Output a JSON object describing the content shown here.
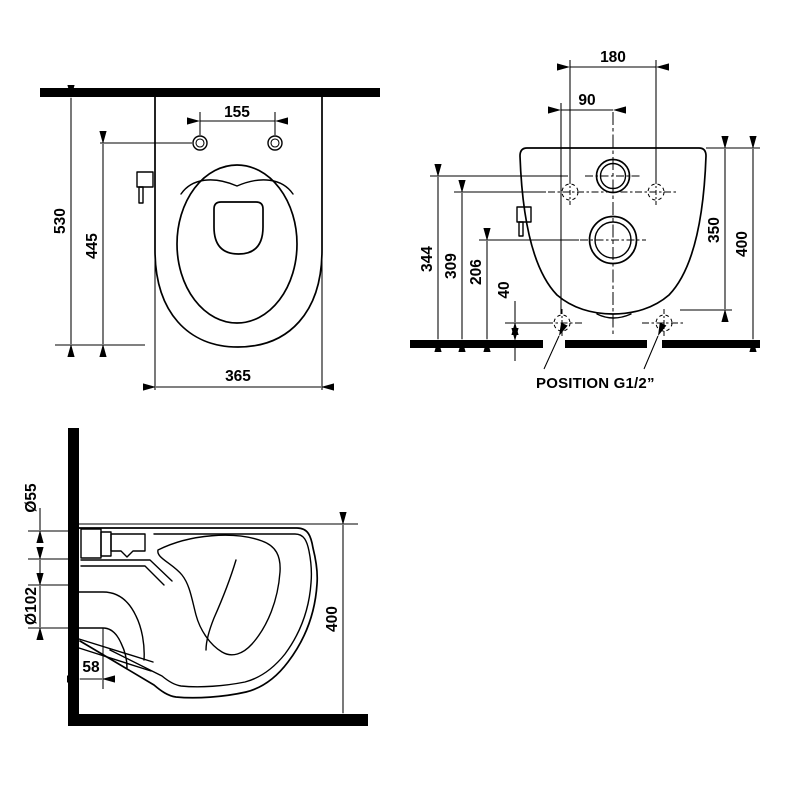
{
  "title": "Wall-hung toilet installation drawing",
  "colors": {
    "line": "#000000",
    "background": "#ffffff"
  },
  "views": {
    "top": {
      "dim_hole_spacing": "155",
      "dim_depth_total": "530",
      "dim_holes_to_front": "445",
      "dim_width": "365"
    },
    "rear": {
      "dim_hole_spacing": "180",
      "dim_center_offset": "90",
      "dim_inlet_height": "344",
      "dim_holes_height": "309",
      "dim_outlet_height": "206",
      "dim_g12_height": "40",
      "dim_body_height": "350",
      "dim_top_height": "400",
      "position_label": "POSITION G1/2”"
    },
    "side": {
      "dim_inlet_diameter": "Ø55",
      "dim_outlet_diameter": "Ø102",
      "dim_outlet_offset": "58",
      "dim_height": "400"
    }
  }
}
